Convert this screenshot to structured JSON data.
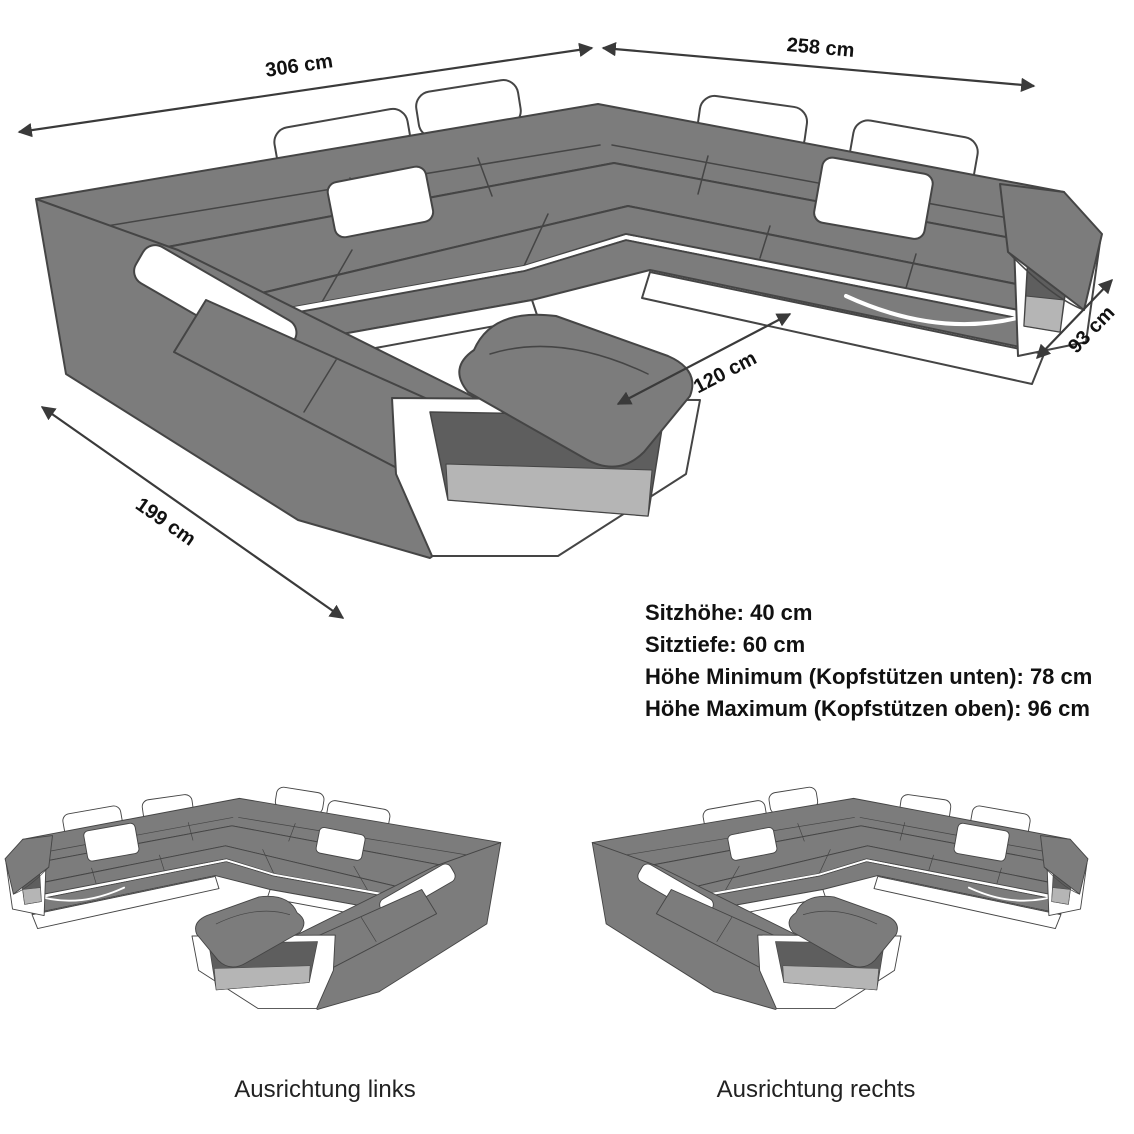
{
  "diagram": {
    "title": "U-shaped sofa dimension diagram",
    "dimensions": {
      "back_width": "306 cm",
      "right_width": "258 cm",
      "left_depth": "199 cm",
      "inner_width": "120 cm",
      "end_depth": "93 cm"
    },
    "specs": {
      "line1": "Sitzhöhe: 40 cm",
      "line2": "Sitztiefe: 60 cm",
      "line3": "Höhe Minimum (Kopfstützen unten): 78 cm",
      "line4": "Höhe Maximum (Kopfstützen oben): 96 cm"
    },
    "variants": {
      "left_label": "Ausrichtung links",
      "right_label": "Ausrichtung rechts"
    },
    "colors": {
      "sofa_gray": "#7c7c7c",
      "outline": "#454545",
      "accent_white": "#ffffff",
      "cutout_dark": "#5e5e5e",
      "cutout_light": "#b5b5b5",
      "text": "#111111"
    }
  }
}
